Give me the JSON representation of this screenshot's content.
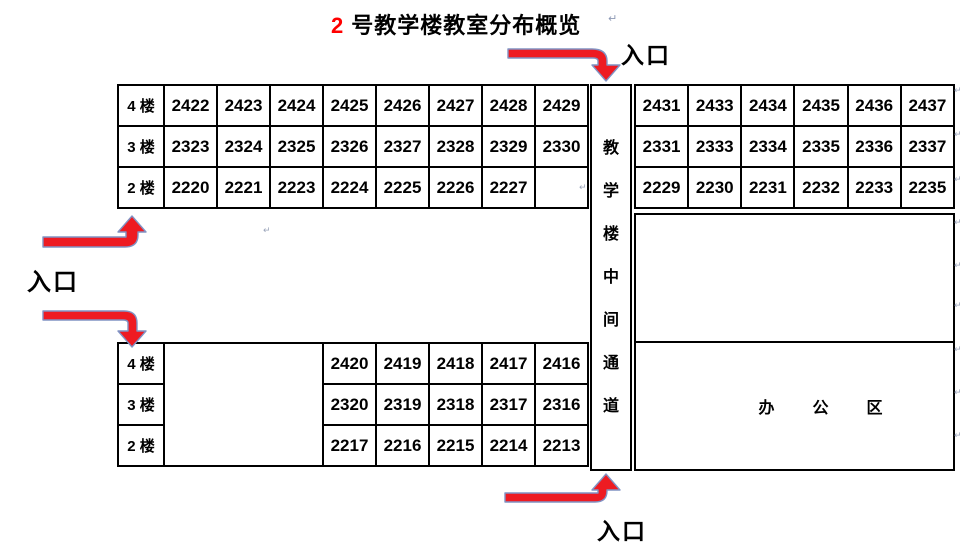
{
  "title": {
    "number": "2",
    "text": "号教学楼教室分布概览"
  },
  "entrance_label": "入口",
  "corridor": {
    "name": "教学楼中间通道",
    "chars": [
      "教",
      "学",
      "楼",
      "中",
      "间",
      "通",
      "道"
    ]
  },
  "office": {
    "name": "办公区",
    "chars": [
      "办",
      "公",
      "区"
    ]
  },
  "tables": {
    "top_left": {
      "rows": [
        {
          "floor": "4 楼",
          "rooms": [
            "2422",
            "2423",
            "2424",
            "2425",
            "2426",
            "2427",
            "2428",
            "2429"
          ]
        },
        {
          "floor": "3 楼",
          "rooms": [
            "2323",
            "2324",
            "2325",
            "2326",
            "2327",
            "2328",
            "2329",
            "2330"
          ]
        },
        {
          "floor": "2 楼",
          "rooms": [
            "2220",
            "2221",
            "2223",
            "2224",
            "2225",
            "2226",
            "2227",
            ""
          ]
        }
      ]
    },
    "top_right": {
      "rows": [
        {
          "rooms": [
            "2431",
            "2433",
            "2434",
            "2435",
            "2436",
            "2437"
          ]
        },
        {
          "rooms": [
            "2331",
            "2333",
            "2334",
            "2335",
            "2336",
            "2337"
          ]
        },
        {
          "rooms": [
            "2229",
            "2230",
            "2231",
            "2232",
            "2233",
            "2235"
          ]
        }
      ]
    },
    "bottom_left": {
      "rows": [
        {
          "floor": "4 楼",
          "rooms": [
            "2420",
            "2419",
            "2418",
            "2417",
            "2416"
          ]
        },
        {
          "floor": "3 楼",
          "rooms": [
            "2320",
            "2319",
            "2318",
            "2317",
            "2316"
          ]
        },
        {
          "floor": "2 楼",
          "rooms": [
            "2217",
            "2216",
            "2215",
            "2214",
            "2213"
          ]
        }
      ]
    }
  },
  "marks": {
    "glyph": "↵"
  },
  "colors": {
    "title_accent": "#ff0000",
    "arrow_fill": "#ee1b22",
    "arrow_outline": "#8193c4",
    "border": "#000000",
    "text": "#000000",
    "paragraph_mark": "#8d99b5"
  }
}
